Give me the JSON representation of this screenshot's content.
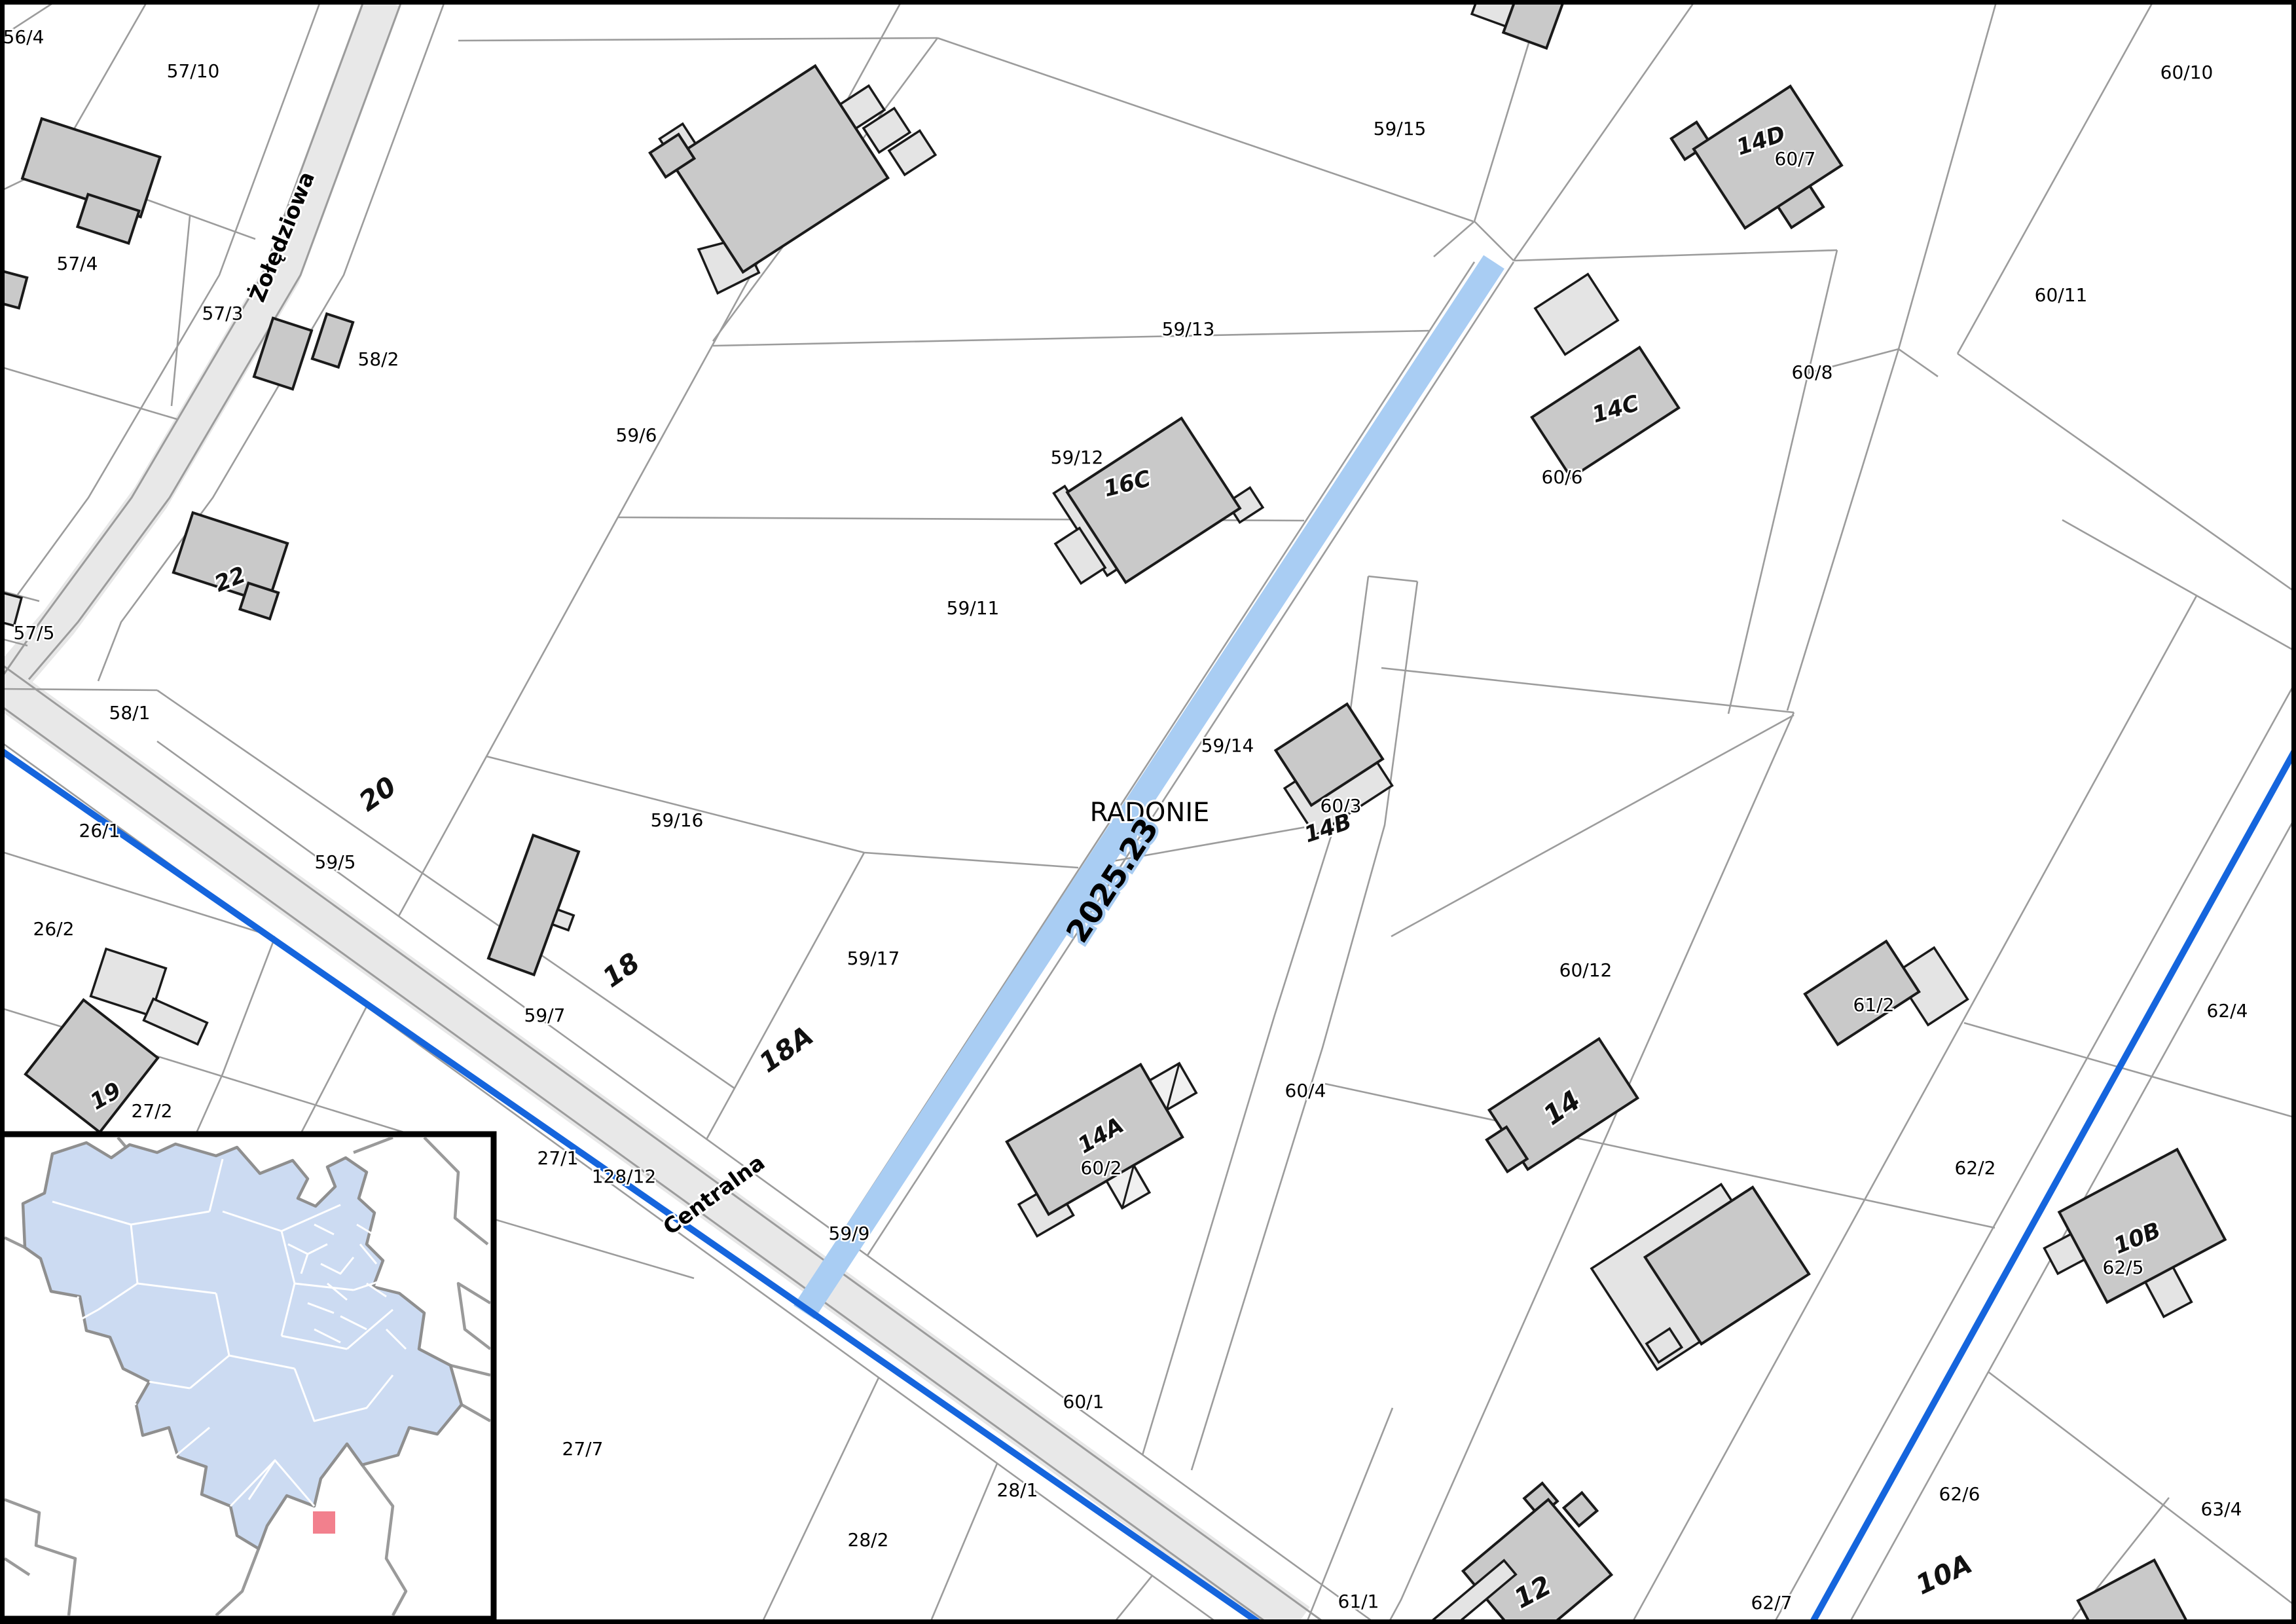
{
  "map": {
    "locality": "RADONIE",
    "route_label": "2025.23",
    "streets": {
      "zoledziowa": "Żołędziowa",
      "centralna": "Centralna"
    },
    "parcels": {
      "56_4": "56/4",
      "57_10": "57/10",
      "57_4": "57/4",
      "57_3": "57/3",
      "57_5": "57/5",
      "58_2": "58/2",
      "58_1": "58/1",
      "59_6": "59/6",
      "59_13": "59/13",
      "59_15": "59/15",
      "59_12": "59/12",
      "59_11": "59/11",
      "59_16": "59/16",
      "59_17": "59/17",
      "59_5": "59/5",
      "59_7": "59/7",
      "59_9": "59/9",
      "59_14": "59/14",
      "26_1": "26/1",
      "26_2": "26/2",
      "27_2": "27/2",
      "27_1": "27/1",
      "27_7": "27/7",
      "128_12": "128/12",
      "28_1": "28/1",
      "28_2": "28/2",
      "60_10": "60/10",
      "60_7": "60/7",
      "60_11": "60/11",
      "60_8": "60/8",
      "60_6": "60/6",
      "60_3": "60/3",
      "60_4": "60/4",
      "60_2": "60/2",
      "60_1": "60/1",
      "60_12": "60/12",
      "61_2": "61/2",
      "61_1": "61/1",
      "62_4": "62/4",
      "62_2": "62/2",
      "62_5": "62/5",
      "62_6": "62/6",
      "62_7": "62/7",
      "63_4": "63/4"
    },
    "addresses": {
      "a22": "22",
      "a20": "20",
      "a19": "19",
      "a18": "18",
      "a18A": "18A",
      "a16C": "16C",
      "a14A": "14A",
      "a14B": "14B",
      "a14C": "14C",
      "a14D": "14D",
      "a14": "14",
      "a12": "12",
      "a10A": "10A",
      "a10B": "10B"
    }
  },
  "colors": {
    "parcel_line": "#9c9c9c",
    "road_fill": "#e8e8e8",
    "building_fill": "#c9c9c9",
    "building_light_fill": "#e4e4e4",
    "utility_blue": "#1565dd",
    "route_highlight": "#a9cdf3",
    "route_text": "#14284b",
    "inset_region": "#ccdbf2",
    "inset_marker": "#f2808d"
  }
}
